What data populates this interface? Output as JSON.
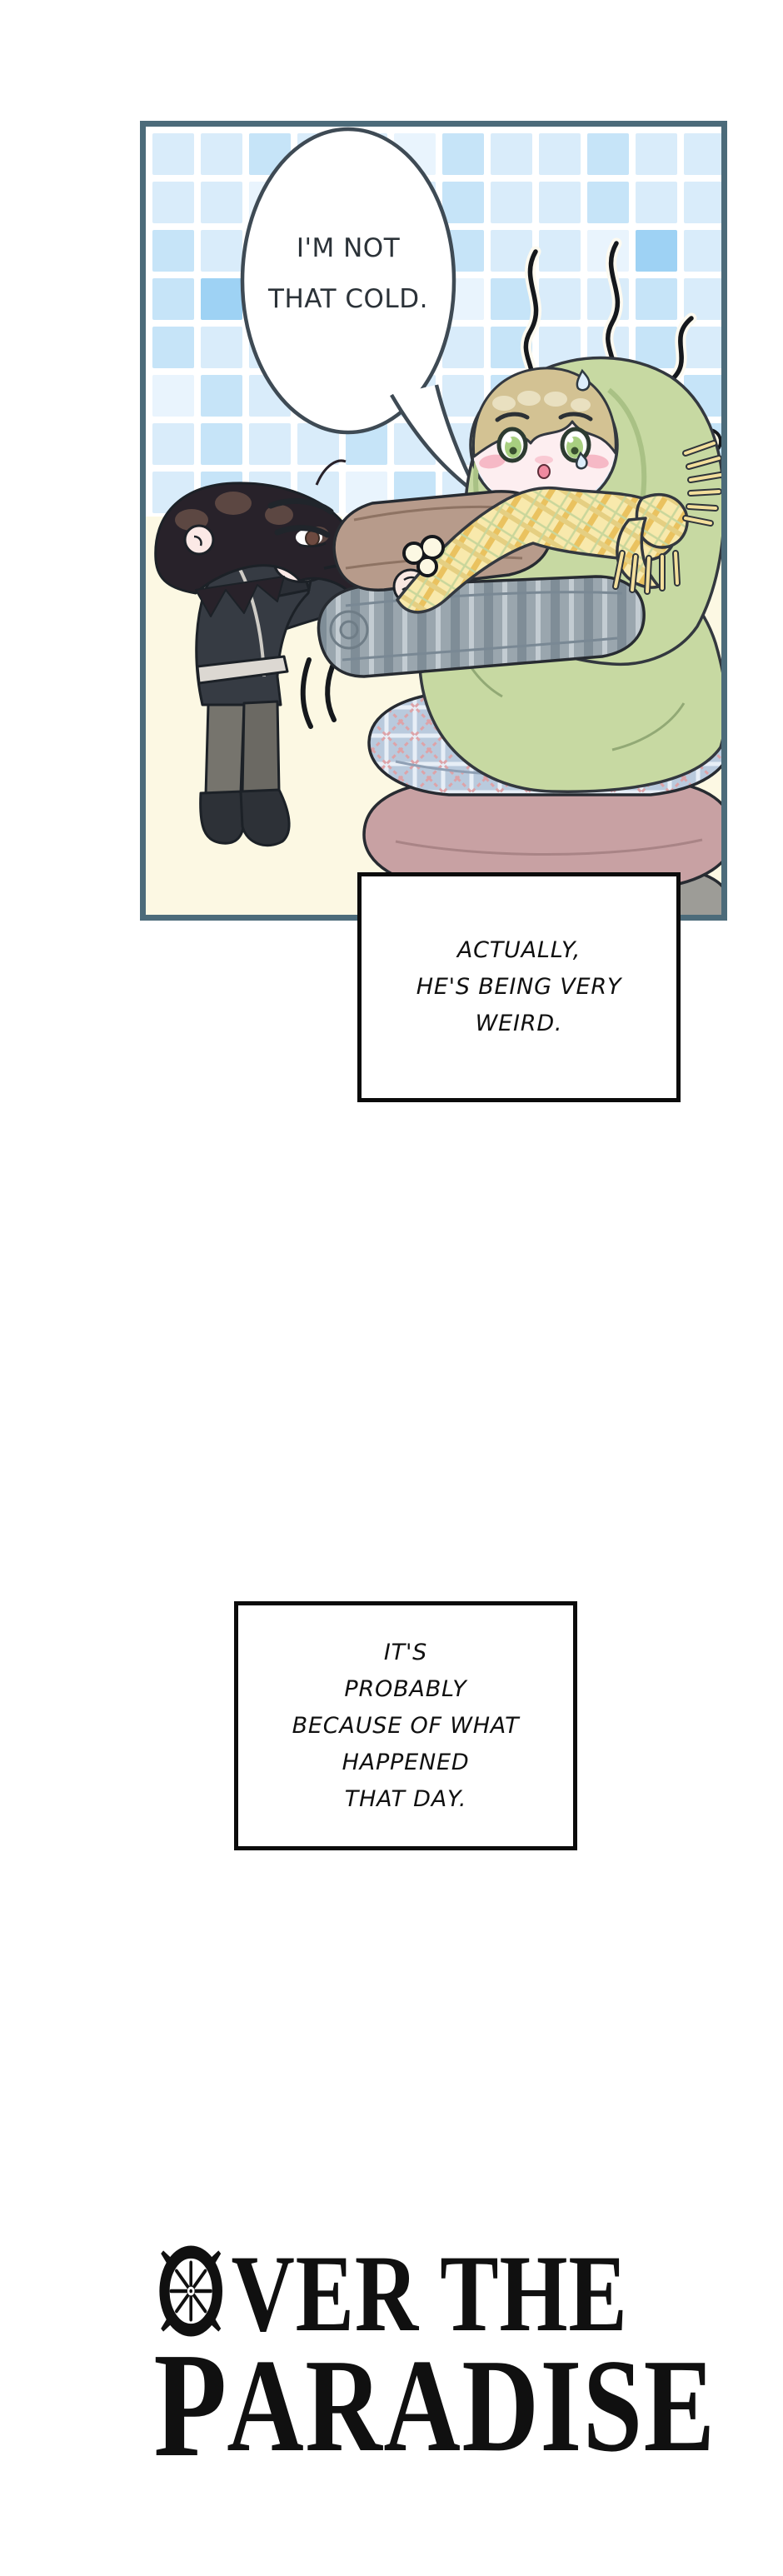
{
  "panel": {
    "speech_bubble": {
      "text": "I'M NOT\nTHAT COLD."
    }
  },
  "caption_boxes": [
    {
      "text": "ACTUALLY,\nHE'S BEING VERY\nWEIRD."
    },
    {
      "text": "IT'S\nPROBABLY\nBECAUSE OF WHAT\nHAPPENED\nTHAT DAY."
    }
  ],
  "logo": {
    "title": "OVER THE PARADISE",
    "line1_initial": "O",
    "line1_rest": "VER THE",
    "line2_initial": "P",
    "line2_rest": "ARADISE"
  },
  "colors": {
    "page_bg": "#ffffff",
    "ink": "#1d2329",
    "panel_border": "#4c6b7a",
    "panel_bg": "#fcf8e3",
    "grout": "#ffffff",
    "tile": "#d9ecfa",
    "tile_alt": "#c6e4f8",
    "tile_pale": "#e9f4fd",
    "tile_accent": "#9ed2f4",
    "bubble_fill": "#ffffff",
    "bubble_outline": "#3e4a54",
    "hood_green": "#c7d9a2",
    "hood_shade": "#a9c185",
    "hair_blond": "#d3c293",
    "hair_dark": "#28222a",
    "skin": "#fdeef0",
    "blush": "#f6b9c6",
    "eye_green": "#a8cf80",
    "scarf_yellow": "#f8e9ac",
    "scarf_gold": "#eac25f",
    "cushion_blue": "#b9cadd",
    "cushion_pink": "#c8a1a3",
    "cushion_gray": "#9d9c97",
    "blanket_brown": "#b79b8b",
    "blanket_gray": "#9aa6ae",
    "uniform_dark": "#363b43",
    "uniform_trim": "#dcd8d2",
    "chevron_gold": "#d7a440",
    "pants_gray": "#76746d",
    "boot_black": "#2d3137",
    "caption_ink": "#101010",
    "logo_black": "#101010"
  }
}
